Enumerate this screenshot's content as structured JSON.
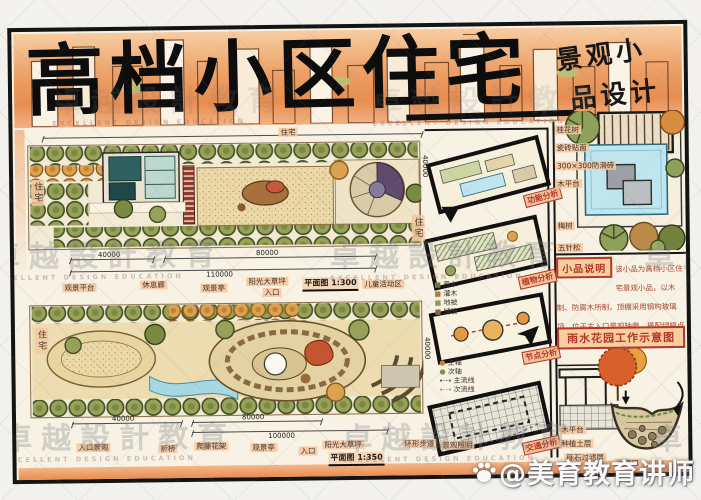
{
  "board": {
    "title": "高档小区住宅",
    "subtitle_line1": "景观小",
    "subtitle_line2": "品设计"
  },
  "watermark": {
    "cn": "卓越設計教育",
    "en": "EXCELLENT DESIGN EDUCATION"
  },
  "credit": "@美育教育讲师",
  "plan1": {
    "label_top": "住宅",
    "label_left": "住宅",
    "label_right": "住宅",
    "dims": {
      "left": "40000",
      "right": "80000",
      "total": "110000",
      "side": "40000"
    },
    "scale_note": "平面图 1:300",
    "callouts": [
      "观景平台",
      "休息廊",
      "观景亭",
      "阳光大草坪",
      "入口",
      "儿童活动区"
    ]
  },
  "plan2": {
    "label_left": "住宅",
    "dims": {
      "left": "40000",
      "mid": "80000",
      "right": "100000",
      "side": "40000"
    },
    "scale_note": "平面图 1:350",
    "callouts": [
      "入口景观",
      "折桥",
      "爬藤花架",
      "观景亭",
      "入口",
      "阳光大草坪",
      "环形步道",
      "景观照明"
    ]
  },
  "analysis": {
    "items": [
      {
        "label": "功能分析"
      },
      {
        "label": "植物分析"
      },
      {
        "label": "节点分析"
      },
      {
        "label": "交通分析"
      }
    ],
    "legend": [
      "主轴",
      "次轴",
      "主流线",
      "次流线"
    ],
    "notes": [
      "乔木",
      "灌木",
      "地被",
      "铺装"
    ]
  },
  "detail": {
    "callouts": [
      "桂花树",
      "瓷砖贴面",
      "300×300防滑砖",
      "木平台",
      "梅树",
      "五针松"
    ],
    "note_label": "小品说明",
    "note_text": "该小品为高档小区住宅景观小品，以木制、防腐木所制，顶棚采用钢构玻璃顶，位于主入口景观轴旁，搭配绿植点缀，清新雅致，整体舒适美观。",
    "rain_title": "雨水花园工作示意图",
    "rain_callouts": [
      "木平台",
      "种植土层",
      "砾石过滤层",
      "溢流口"
    ]
  },
  "colors": {
    "paper": "#f7f2e3",
    "banner_orange": "#e8945a",
    "tree_olive": "#98a158",
    "tree_orange": "#dca24f",
    "water": "#a5d8e4",
    "label_red": "#b3372a",
    "callout_bg": "#f6c9a4"
  }
}
